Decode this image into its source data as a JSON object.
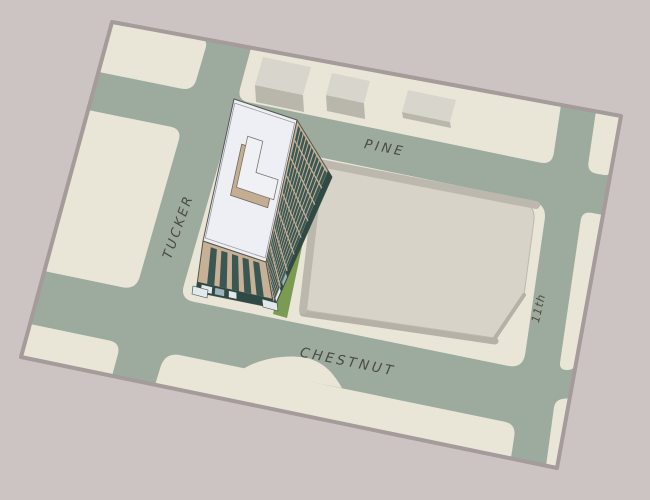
{
  "map": {
    "description": "aerial site plan with 3D office tower massing",
    "streets": {
      "north": "PINE",
      "west": "TUCKER",
      "south": "CHESTNUT",
      "east": "11th"
    }
  },
  "palette": {
    "page_bg": "#ccc4c3",
    "boundary_stroke": "#a49b9a",
    "street": "#9dab9f",
    "block": "#e9e6d8",
    "pad_top": "#d7d3c8",
    "pad_rim": "#bcb8ae",
    "pad_shadow": "#b5b1a6",
    "lawn": "#7b9b53",
    "building_tan": "#c6b096",
    "building_window": "#3a5753",
    "building_base": "#2f4a45",
    "building_roof": "#edeff4",
    "building_outline": "#56554d",
    "penthouse_side": "#c3ae93",
    "penthouse_top": "#f0f1f5",
    "small_bldg_top": "#d8d6cc",
    "small_bldg_front": "#b9b7ac",
    "storefront_light": "#e3e9ea",
    "storefront_glass": "#9db3bc",
    "label_text": "#4b4a40"
  }
}
